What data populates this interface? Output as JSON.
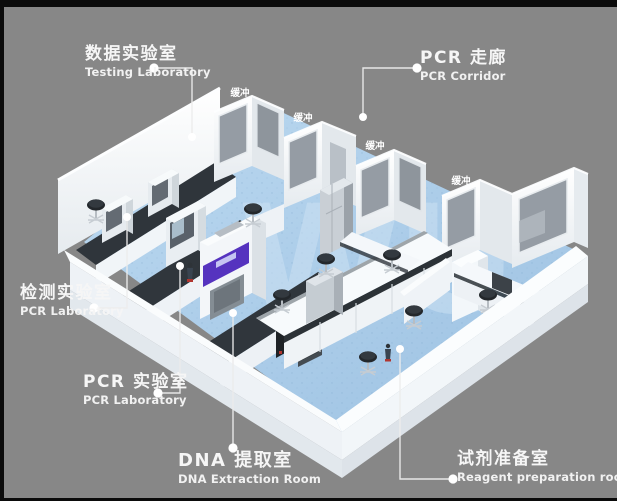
{
  "frame": {
    "background_color": "#878787",
    "border_color": "#0b0b0b"
  },
  "watermark": {
    "text": "WU",
    "color": "#cfe3f4"
  },
  "callouts": [
    {
      "id": "testing-laboratory",
      "zh": "数据实验室",
      "en": "Testing Laboratory"
    },
    {
      "id": "pcr-corridor",
      "zh": "PCR 走廊",
      "en": "PCR Corridor"
    },
    {
      "id": "detection-laboratory",
      "zh": "检测实验室",
      "en": "PCR Laboratory"
    },
    {
      "id": "pcr-laboratory",
      "zh": "PCR 实验室",
      "en": "PCR Laboratory"
    },
    {
      "id": "dna-extraction-room",
      "zh": "DNA 提取室",
      "en": "DNA Extraction Room"
    },
    {
      "id": "reagent-preparation-room",
      "zh": "试剂准备室",
      "en": "Reagent preparation room"
    }
  ],
  "buffer_rooms": {
    "labels": [
      "缓冲",
      "缓冲",
      "缓冲",
      "缓冲"
    ]
  },
  "palette": {
    "floor_blue": "#aed0ec",
    "wall_white": "#f5f8fa",
    "window_gray": "#959ca4",
    "counter_dark": "#2e3338",
    "equipment_purple": "#5533bf"
  }
}
